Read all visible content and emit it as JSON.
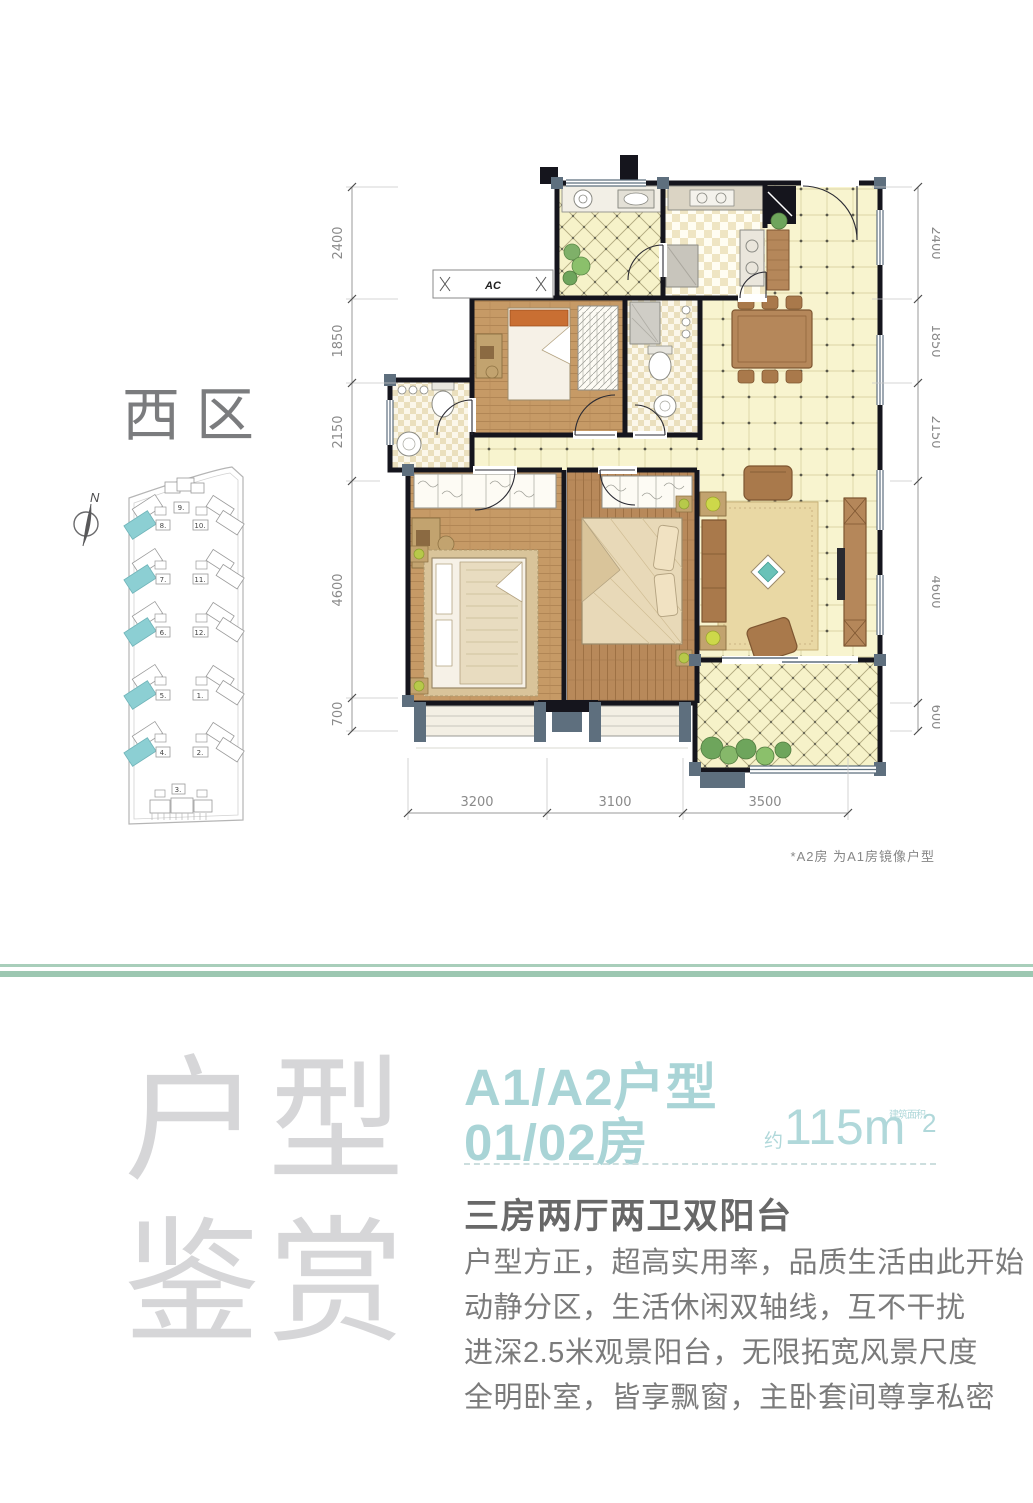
{
  "site_plan": {
    "district_label": "西区",
    "north_label": "N",
    "building_top": "9.",
    "buildings_left": [
      "8.",
      "7.",
      "6.",
      "5.",
      "4."
    ],
    "buildings_right": [
      "10.",
      "11.",
      "12.",
      "1.",
      "2."
    ],
    "building_bottom": "3."
  },
  "floor_plan": {
    "ac_label": "AC",
    "dims_left": [
      "2400",
      "1850",
      "2150",
      "4600",
      "700"
    ],
    "dims_right": [
      "2400",
      "1850",
      "2150",
      "4600",
      "600"
    ],
    "dims_bottom": [
      "3200",
      "3100",
      "3500"
    ],
    "footnote": "*A2房 为A1房镜像户型"
  },
  "info": {
    "watermark_chars": [
      "户",
      "型",
      "鉴",
      "赏"
    ],
    "title_line1": "A1/A2户型",
    "title_line2": "01/02房",
    "area_approx": "约",
    "area_value": "115m",
    "area_note": "建筑面积",
    "area_superscript": "2",
    "subtitle": "三房两厅两卫双阳台",
    "description_lines": [
      "户型方正，超高实用率，品质生活由此开始",
      "动静分区，生活休闲双轴线，互不干扰",
      "进深2.5米观景阳台，无限拓宽风景尺度",
      "全明卧室，皆享飘窗，主卧套间尊享私密"
    ]
  },
  "colors": {
    "accent_teal": "#a9d4d6",
    "divider_green": "#9cc7b1",
    "wall_dark": "#15151d",
    "highlight_building": "#8ccfd3"
  }
}
